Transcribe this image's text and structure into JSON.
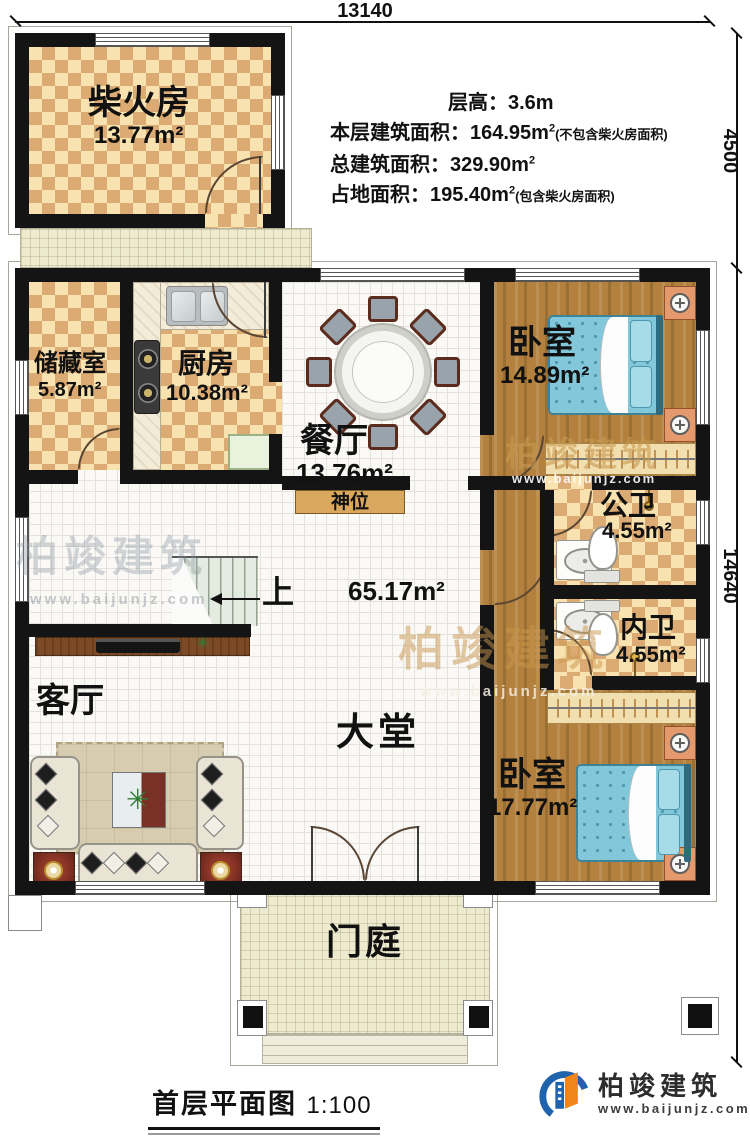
{
  "dimensions": {
    "width_top": "13140",
    "height_upper": "4500",
    "height_main": "14640"
  },
  "info": {
    "lines": [
      {
        "main": "层高：3.6m",
        "sup": "",
        "note": ""
      },
      {
        "main": "本层建筑面积：164.95m",
        "sup": "2",
        "note": "(不包含柴火房面积)"
      },
      {
        "main": "总建筑面积：329.90m",
        "sup": "2",
        "note": ""
      },
      {
        "main": "占地面积：195.40m",
        "sup": "2",
        "note": "(包含柴火房面积)"
      }
    ]
  },
  "rooms": {
    "chaihuofang": {
      "name": "柴火房",
      "area": "13.77m²"
    },
    "chucangshi": {
      "name": "储藏室",
      "area": "5.87m²"
    },
    "chufang": {
      "name": "厨房",
      "area": "10.38m²"
    },
    "canting": {
      "name": "餐厅",
      "area": "13.76m²"
    },
    "woshi_top": {
      "name": "卧室",
      "area": "14.89m²"
    },
    "gongwei": {
      "name": "公卫",
      "area": "4.55m²"
    },
    "neiwei": {
      "name": "内卫",
      "area": "4.55m²"
    },
    "woshi_bottom": {
      "name": "卧室",
      "area": "17.77m²"
    },
    "datang": {
      "name": "大堂",
      "area": "65.17m²"
    },
    "keting": {
      "name": "客厅"
    },
    "menting": {
      "name": "门庭"
    }
  },
  "labels": {
    "shrine": "神位",
    "stairs_up": "上"
  },
  "title": {
    "main": "首层平面图",
    "scale": "1:100"
  },
  "logo": {
    "name": "柏竣建筑",
    "site": "www.baijunjz.com"
  },
  "watermark": {
    "text": "柏竣建筑",
    "site": "www.baijunjz.com"
  },
  "icons": {
    "plant": "✳"
  },
  "colors": {
    "wall": "#141414",
    "checker_light": "#f8e2af",
    "checker_dark": "#dcaa73",
    "wood": "#b3813d",
    "bed_blue": "#82c7da",
    "cream": "#edeacf",
    "logo_blue": "#1f63ac",
    "logo_orange": "#f08519"
  }
}
